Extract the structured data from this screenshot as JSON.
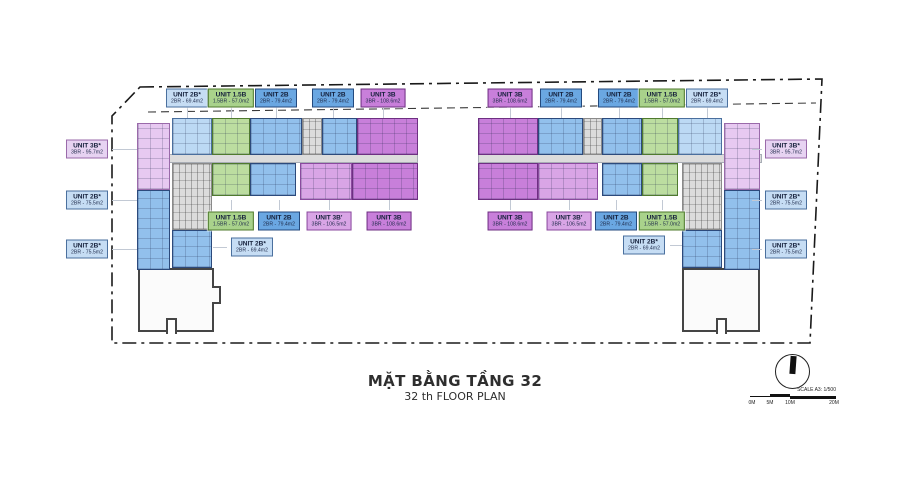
{
  "title": {
    "main": "MẶT BẰNG TẦNG 32",
    "sub": "32 th FLOOR PLAN"
  },
  "scale_bar": {
    "label": "SCALE A3: 1/500",
    "ticks": [
      "0M",
      "5M",
      "10M",
      "20M"
    ]
  },
  "palette": {
    "blue": "#92c0ec",
    "light_blue": "#bcd9f4",
    "green": "#bcdda0",
    "purple": "#c87fda",
    "light_purple": "#d9a5e6",
    "pink": "#e7c9f1",
    "grey": "#dcdcdc",
    "boundary": "#1a1a1a"
  },
  "palette_borders": {
    "blue": "#2c4a7c",
    "light_blue": "#4a6f9e",
    "green": "#4f7a2e",
    "purple": "#6e2f82",
    "light_purple": "#8a4a9e",
    "pink": "#9a6aaa",
    "grey": "#8a8a8a"
  },
  "unit_types": {
    "2B": {
      "label": "UNIT 2B",
      "area": "2BR - 79.4m2",
      "label_bg": "#6aa7e2",
      "border": "#24497e"
    },
    "2B_star_69": {
      "label": "UNIT 2B*",
      "area": "2BR - 69.4m2",
      "label_bg": "#c6ddf4",
      "border": "#4a6f9e"
    },
    "2B_star_75": {
      "label": "UNIT 2B*",
      "area": "2BR - 75.5m2",
      "label_bg": "#c6ddf4",
      "border": "#4a6f9e"
    },
    "1_5B": {
      "label": "UNIT 1.5B",
      "area": "1.5BR - 57.0m2",
      "label_bg": "#a9d28b",
      "border": "#4f7a2e"
    },
    "3B": {
      "label": "UNIT 3B",
      "area": "3BR - 108.6m2",
      "label_bg": "#c87fda",
      "border": "#6e2f82"
    },
    "3B_prime": {
      "label": "UNIT 3B'",
      "area": "3BR - 106.5m2",
      "label_bg": "#d9a5e6",
      "border": "#8a4a9e"
    },
    "3B_star": {
      "label": "UNIT 3B*",
      "area": "3BR - 95.7m2",
      "label_bg": "#e7d3f2",
      "border": "#9a6aaa"
    }
  },
  "labels": [
    {
      "type": "2B_star_69",
      "x": 187,
      "y": 98,
      "lead": "top"
    },
    {
      "type": "1_5B",
      "x": 231,
      "y": 98,
      "lead": "top"
    },
    {
      "type": "2B",
      "x": 276,
      "y": 98,
      "lead": "top"
    },
    {
      "type": "2B",
      "x": 333,
      "y": 98,
      "lead": "top"
    },
    {
      "type": "3B",
      "x": 383,
      "y": 98,
      "lead": "top"
    },
    {
      "type": "3B",
      "x": 510,
      "y": 98,
      "lead": "top"
    },
    {
      "type": "2B",
      "x": 561,
      "y": 98,
      "lead": "top"
    },
    {
      "type": "2B",
      "x": 619,
      "y": 98,
      "lead": "top"
    },
    {
      "type": "1_5B",
      "x": 662,
      "y": 98,
      "lead": "top"
    },
    {
      "type": "2B_star_69",
      "x": 707,
      "y": 98,
      "lead": "top"
    },
    {
      "type": "3B_star",
      "x": 87,
      "y": 149,
      "lead": "left"
    },
    {
      "type": "2B_star_75",
      "x": 87,
      "y": 200,
      "lead": "left"
    },
    {
      "type": "2B_star_75",
      "x": 87,
      "y": 249,
      "lead": "left"
    },
    {
      "type": "3B_star",
      "x": 786,
      "y": 149,
      "lead": "right"
    },
    {
      "type": "2B_star_75",
      "x": 786,
      "y": 200,
      "lead": "right"
    },
    {
      "type": "2B_star_75",
      "x": 786,
      "y": 249,
      "lead": "right"
    },
    {
      "type": "1_5B",
      "x": 231,
      "y": 221,
      "lead": "bottom"
    },
    {
      "type": "2B",
      "x": 279,
      "y": 221,
      "lead": "bottom"
    },
    {
      "type": "3B_prime",
      "x": 329,
      "y": 221,
      "lead": "bottom"
    },
    {
      "type": "3B",
      "x": 389,
      "y": 221,
      "lead": "bottom"
    },
    {
      "type": "2B_star_69",
      "x": 252,
      "y": 247,
      "lead": "lowL"
    },
    {
      "type": "3B",
      "x": 510,
      "y": 221,
      "lead": "bottom"
    },
    {
      "type": "3B_prime",
      "x": 569,
      "y": 221,
      "lead": "bottom"
    },
    {
      "type": "2B",
      "x": 616,
      "y": 221,
      "lead": "bottom"
    },
    {
      "type": "1_5B",
      "x": 662,
      "y": 221,
      "lead": "bottom"
    },
    {
      "type": "2B_star_69",
      "x": 644,
      "y": 245,
      "lead": "lowR"
    }
  ]
}
